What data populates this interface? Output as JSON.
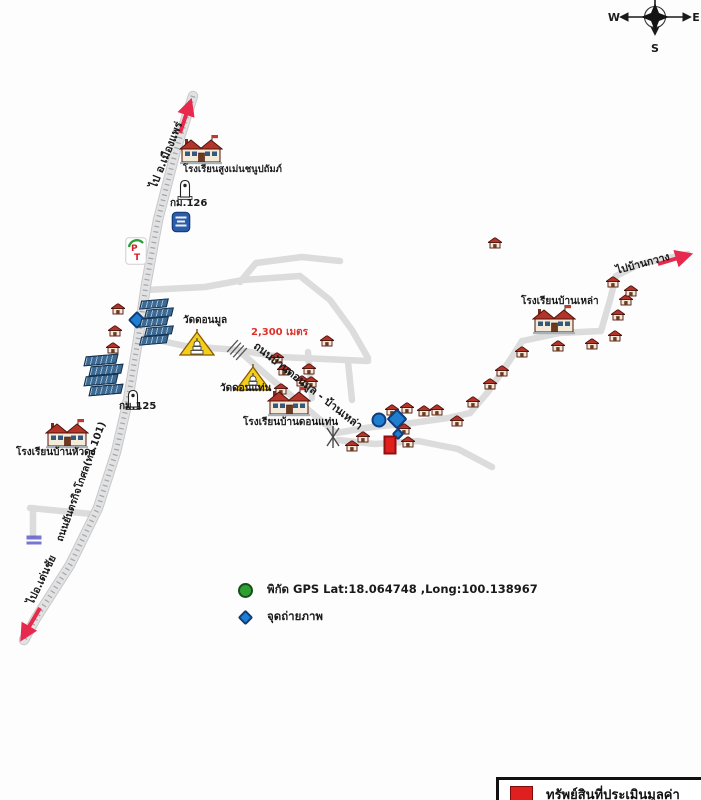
{
  "compass": {
    "west": "W",
    "east": "E",
    "south": "S"
  },
  "legend": {
    "gps_text": "พิกัด GPS Lat:18.064748 ,Long:100.138967",
    "photo_text": "จุดถ่ายภาพ"
  },
  "property_legend": {
    "text": "ทรัพย์สินที่ประเมินมูลค่า"
  },
  "colors": {
    "road": "#d8d8d8",
    "road_tick": "#9fa6ad",
    "branch_road": "#dcdcdc",
    "arrow_red": "#e8294e",
    "distance_red": "#e0322a",
    "house_roof": "#b5342a",
    "temple_yellow": "#f2cf1d",
    "marker_blue": "#1f7ed0",
    "marker_blue_border": "#0d3d7c",
    "gps_green": "#2f9e33",
    "property_red": "#e01f1f",
    "building_blue": "#3b6a94"
  },
  "labels": [
    {
      "id": "to-mueang-phrae",
      "text": "ไป อ.เมืองแพร่",
      "x": 166,
      "y": 155,
      "rot": -68,
      "size": 11,
      "bold": true,
      "center": true
    },
    {
      "id": "school-sungmen",
      "text": "โรงเรียนสูงเม่นชนูปถัมภ์",
      "x": 183,
      "y": 165,
      "size": 9.5,
      "bold": true
    },
    {
      "id": "km-126",
      "text": "กม.126",
      "x": 170,
      "y": 199,
      "size": 10,
      "bold": true
    },
    {
      "id": "wat-donmun",
      "text": "วัดดอนมูล",
      "x": 183,
      "y": 316,
      "size": 10,
      "bold": true
    },
    {
      "id": "distance",
      "text": "2,300 เมตร",
      "x": 251,
      "y": 328,
      "size": 10,
      "bold": true,
      "color": "#e0322a"
    },
    {
      "id": "road-donmun-banlao",
      "text": "ถนนบ้านดอนมูล - บ้านเหล่า",
      "x": 308,
      "y": 386,
      "rot": 38,
      "size": 11,
      "bold": true,
      "center": true
    },
    {
      "id": "wat-donthaen",
      "text": "วัดดอนแท่น",
      "x": 220,
      "y": 384,
      "size": 10,
      "bold": true
    },
    {
      "id": "school-donthaen",
      "text": "โรงเรียนบ้านดอนแท่น",
      "x": 243,
      "y": 418,
      "size": 10,
      "bold": true
    },
    {
      "id": "school-banlao",
      "text": "โรงเรียนบ้านเหล่า",
      "x": 521,
      "y": 297,
      "size": 10,
      "bold": true
    },
    {
      "id": "to-ban-kwang",
      "text": "ไปบ้านกวาง",
      "x": 643,
      "y": 264,
      "rot": -15,
      "size": 10.5,
      "bold": true,
      "center": true
    },
    {
      "id": "road-yantrakitkosol",
      "text": "ถนนยันตรกิจโกศล(ทล.101)",
      "x": 82,
      "y": 482,
      "rot": -70,
      "size": 10,
      "bold": true,
      "center": true
    },
    {
      "id": "school-huadong",
      "text": "โรงเรียนบ้านหัวดง",
      "x": 16,
      "y": 448,
      "size": 10,
      "bold": true
    },
    {
      "id": "to-denchai",
      "text": "ไปอ.เด่นชัย",
      "x": 42,
      "y": 580,
      "rot": -64,
      "size": 10.5,
      "bold": true,
      "center": true
    },
    {
      "id": "km-125",
      "text": "กม.125",
      "x": 119,
      "y": 402,
      "size": 10,
      "bold": true
    }
  ],
  "markers": {
    "houses": [
      [
        118,
        309
      ],
      [
        115,
        331
      ],
      [
        113,
        348
      ],
      [
        327,
        341
      ],
      [
        277,
        358
      ],
      [
        284,
        370
      ],
      [
        309,
        369
      ],
      [
        302,
        381
      ],
      [
        281,
        389
      ],
      [
        311,
        382
      ],
      [
        392,
        410
      ],
      [
        407,
        408
      ],
      [
        424,
        411
      ],
      [
        437,
        410
      ],
      [
        457,
        421
      ],
      [
        473,
        402
      ],
      [
        490,
        384
      ],
      [
        502,
        371
      ],
      [
        522,
        352
      ],
      [
        558,
        346
      ],
      [
        592,
        344
      ],
      [
        615,
        336
      ],
      [
        618,
        315
      ],
      [
        626,
        300
      ],
      [
        631,
        291
      ],
      [
        613,
        282
      ],
      [
        404,
        429
      ],
      [
        408,
        442
      ],
      [
        363,
        437
      ],
      [
        352,
        446
      ],
      [
        495,
        243
      ]
    ],
    "schools": [
      {
        "x": 201,
        "y": 150
      },
      {
        "x": 67,
        "y": 434
      },
      {
        "x": 289,
        "y": 402
      },
      {
        "x": 554,
        "y": 320
      }
    ],
    "temples": [
      {
        "x": 197,
        "y": 343
      },
      {
        "x": 253,
        "y": 378
      }
    ],
    "km_markers": [
      {
        "x": 185,
        "y": 189
      },
      {
        "x": 133,
        "y": 399
      }
    ],
    "photo_diamonds": [
      {
        "x": 137,
        "y": 320,
        "s": 13
      },
      {
        "x": 397,
        "y": 419,
        "s": 15
      },
      {
        "x": 398,
        "y": 434,
        "s": 9
      }
    ],
    "photo_circle": {
      "x": 379,
      "y": 420,
      "r": 15
    },
    "property": {
      "x": 390,
      "y": 445,
      "w": 13,
      "h": 19
    },
    "building_clusters": [
      {
        "x": 143,
        "y": 299,
        "rows": 5,
        "w": 25,
        "h": 7
      },
      {
        "x": 88,
        "y": 355,
        "rows": 4,
        "w": 30,
        "h": 8
      }
    ],
    "pt_station": {
      "x": 136,
      "y": 251
    },
    "blue_logo": {
      "x": 181,
      "y": 222
    },
    "mini_sign": {
      "x": 34,
      "y": 540
    }
  }
}
